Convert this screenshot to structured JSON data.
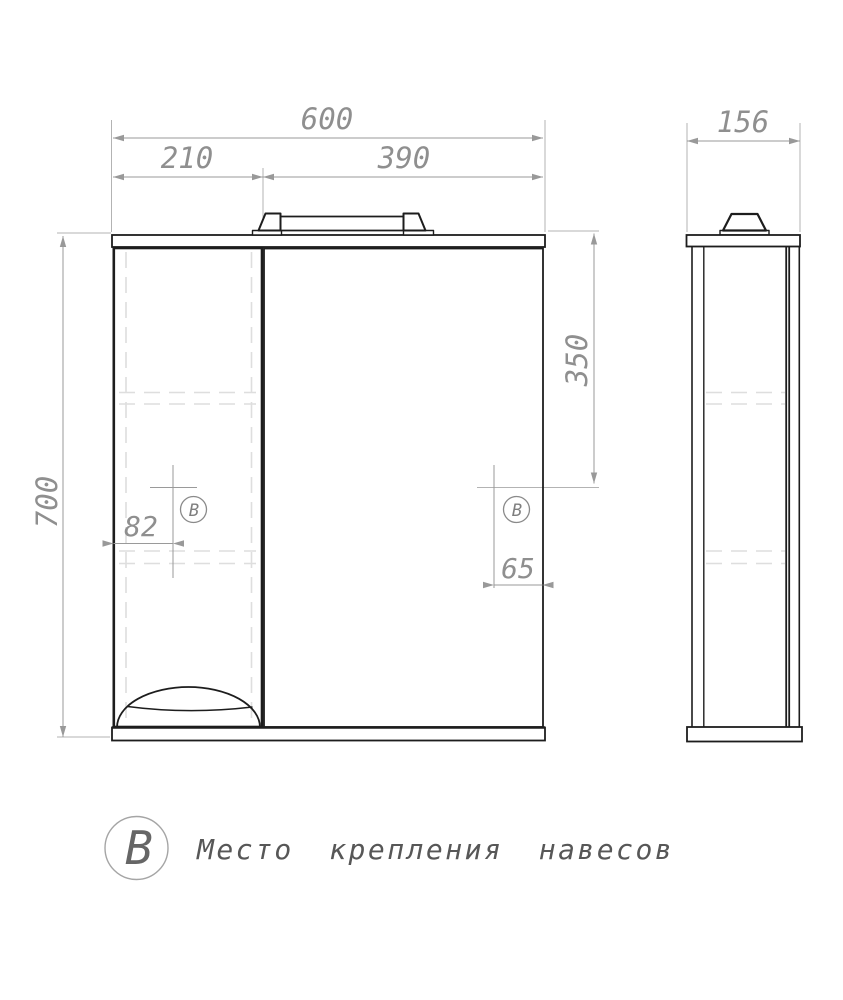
{
  "front_view": {
    "dim_total_width": "600",
    "dim_left_section_width": "210",
    "dim_right_section_width": "390",
    "dim_height": "700",
    "dim_mount_from_top": "350",
    "dim_left_mount_inset": "82",
    "dim_right_mount_inset": "65",
    "left_mount_marker": "В",
    "right_mount_marker": "В"
  },
  "side_view": {
    "dim_depth": "156"
  },
  "legend": {
    "marker": "В",
    "label": "Место крепления навесов"
  },
  "colors": {
    "object_line": "#1d1d1d",
    "dimension_line": "#9a9a9a",
    "dimension_text": "#8f8f8f",
    "hidden_line": "#dedede",
    "legend_text": "#575757",
    "background": "#ffffff"
  }
}
